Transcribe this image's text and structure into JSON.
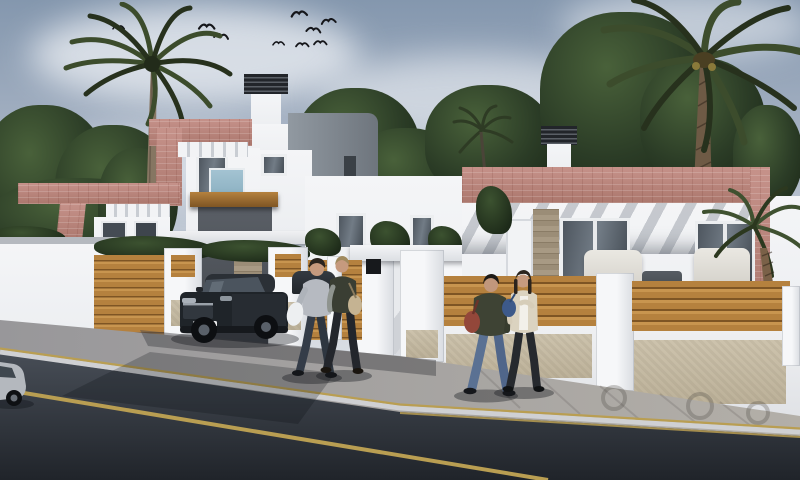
{
  "meta": {
    "title": "Street view 3D rendering of new-build villas",
    "scene_type": "architectural-exterior-render"
  },
  "palette": {
    "sky_top": "#8497ae",
    "sky_mid": "#a7b3c4",
    "sky_horizon": "#ccd3dc",
    "cloud": "#eef1f5",
    "foliage_light": "#49613a",
    "foliage": "#2b3c26",
    "foliage_dark": "#1d2a19",
    "palm_frond": "#3c4c2c",
    "palm_frond_dark": "#27311d",
    "palm_trunk": "#867662",
    "palm_trunk_dark": "#6e5a45",
    "wall_white": "#eceef1",
    "wall_shadow": "#c6cad1",
    "salmon": "#c6928a",
    "salmon_dark": "#ab776d",
    "gray_volume": "#9199a1",
    "gray_volume_dark": "#6e757d",
    "slat_dark": "#22252a",
    "glass": "#59626b",
    "balcony_glass": "#a3c3d2",
    "wood": "#b5813e",
    "wood_dark": "#7e5524",
    "wood_light": "#c8954f",
    "stone": "#b3a692",
    "beige_wall": "#cdc3ad",
    "sidewalk": "#a3a1a0",
    "curb": "#cfd0d3",
    "asphalt": "#474d56",
    "asphalt_dark": "#20242a",
    "road_yellow": "#b99e52",
    "car_body": "#1f2429",
    "car_glass": "#4b545e",
    "car_silver": "#b4b8be",
    "skin": "#c69a7e",
    "shadow": "rgba(12,15,19,0.35)"
  },
  "scene": {
    "sky": {
      "clouds": 5,
      "birds": 9
    },
    "vegetation": {
      "palm_trees": 4,
      "background_trees": "dense dark-green tree masses",
      "hedges": "clipped hedges behind street fence"
    },
    "buildings": [
      {
        "name": "two-story-villa-left",
        "features": [
          "salmon brick pergola frames",
          "white chimney with louvered cap",
          "gray cubic volume",
          "balcony with blue glass",
          "carport with wood lintel"
        ]
      },
      {
        "name": "single-story-villa-right",
        "features": [
          "salmon brick parapet band",
          "pergola stripe shadows",
          "two sliding glass doors",
          "stone-clad entry strip",
          "louvered chimney cap",
          "white terrace sofas"
        ]
      }
    ],
    "street": {
      "fence": "white pillars with horizontal wood-slat panels",
      "sidewalk": "gray cobblestone with circular motifs",
      "road": "dark asphalt",
      "markings": [
        "yellow center line",
        "yellow curb lines"
      ]
    },
    "vehicles": [
      "dark SUV parked at carport",
      "silver car partially visible at left edge",
      "dark car behind fence"
    ],
    "people": [
      "pedestrian pair walking at center",
      "pedestrian pair walking at right"
    ]
  }
}
